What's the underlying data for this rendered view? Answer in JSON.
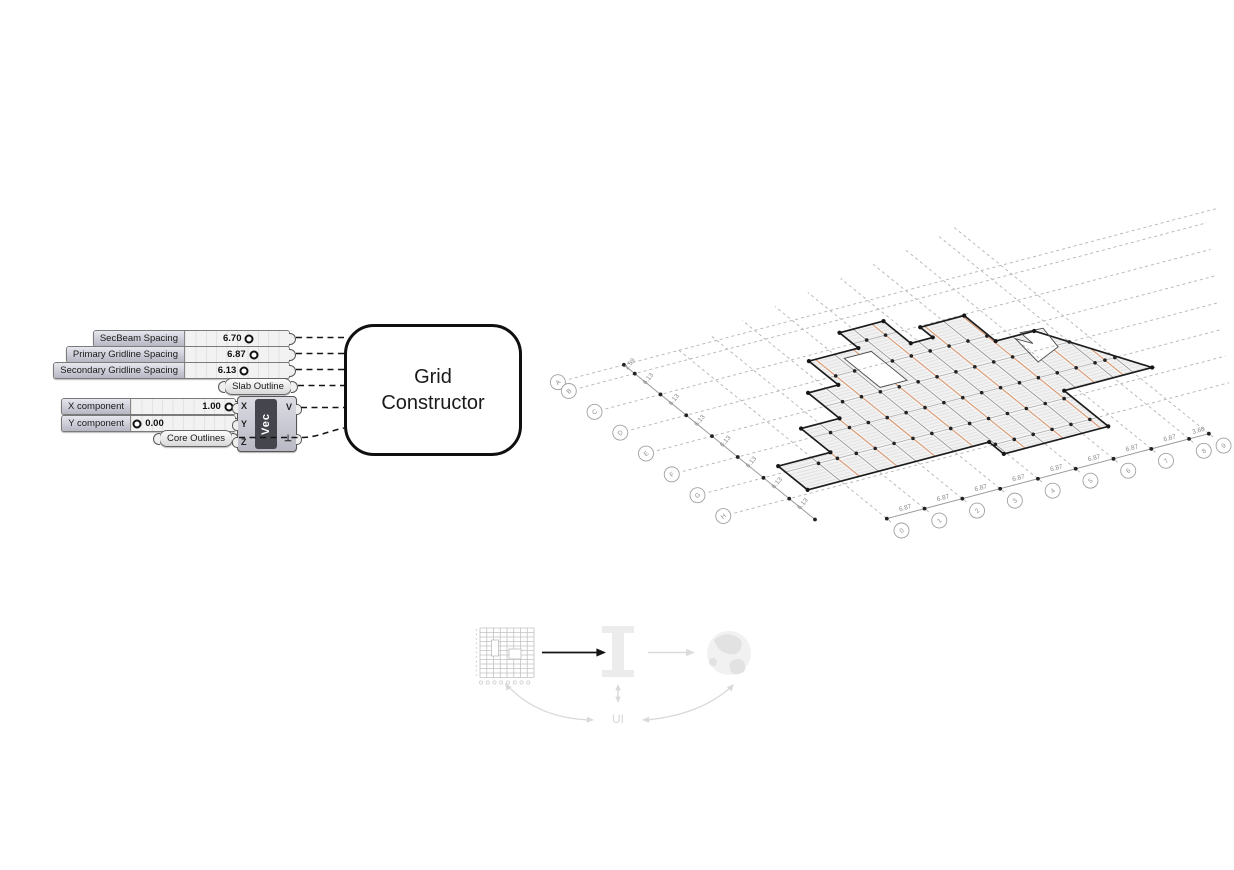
{
  "gh": {
    "sliders": [
      {
        "label": "SecBeam Spacing",
        "value": "6.70",
        "knob_pct": 62,
        "value_side": "left"
      },
      {
        "label": "Primary Gridline Spacing",
        "value": "6.87",
        "knob_pct": 66,
        "value_side": "left"
      },
      {
        "label": "Secondary Gridline Spacing",
        "value": "6.13",
        "knob_pct": 57,
        "value_side": "left"
      },
      {
        "label": "X component",
        "value": "1.00",
        "knob_pct": 94,
        "value_side": "left"
      },
      {
        "label": "Y component",
        "value": "0.00",
        "knob_pct": 6,
        "value_side": "right"
      }
    ],
    "params": {
      "slab": "Slab Outline",
      "core": "Core Outlines"
    },
    "vec": {
      "label": "Vec",
      "inputs": [
        "X",
        "Y",
        "Z"
      ],
      "outputs": [
        "V",
        "⊥"
      ]
    },
    "cluster": {
      "line1": "Grid",
      "line2": "Constructor"
    }
  },
  "axon": {
    "letters": [
      "A",
      "B",
      "C",
      "D",
      "E",
      "F",
      "G",
      "H"
    ],
    "numbers": [
      "0",
      "1",
      "2",
      "3",
      "4",
      "5",
      "6",
      "7",
      "8",
      "9"
    ],
    "secondary_dims": [
      2.59,
      6.13,
      6.13,
      6.13,
      6.13,
      6.13,
      6.13,
      6.13
    ],
    "primary_dims": [
      6.87,
      6.87,
      6.87,
      6.87,
      6.87,
      6.87,
      6.87,
      6.87,
      3.6
    ],
    "slab_outline": [
      [
        -6,
        7
      ],
      [
        27,
        7
      ],
      [
        27,
        3.5
      ],
      [
        46,
        3.5
      ],
      [
        46,
        14
      ],
      [
        62,
        14
      ],
      [
        52,
        29
      ],
      [
        45,
        29
      ],
      [
        45,
        36.5
      ],
      [
        37,
        36.5
      ],
      [
        37,
        33.5
      ],
      [
        33,
        33.5
      ],
      [
        33,
        40
      ],
      [
        25,
        40
      ],
      [
        25,
        35.5
      ],
      [
        16,
        35.5
      ],
      [
        16,
        28.5
      ],
      [
        10.5,
        28.5
      ],
      [
        10.5,
        21
      ],
      [
        3.5,
        21
      ],
      [
        3.5,
        14
      ],
      [
        -6,
        14
      ]
    ],
    "openings": [
      [
        [
          21.3,
          25.5
        ],
        [
          26.2,
          25.5
        ],
        [
          26.2,
          34
        ],
        [
          21.3,
          34
        ]
      ],
      [
        [
          47.3,
          21.9
        ],
        [
          52.6,
          24.1
        ],
        [
          53.7,
          29.1
        ],
        [
          49.8,
          29.4
        ],
        [
          49.7,
          26.3
        ],
        [
          48.1,
          28.4
        ]
      ]
    ],
    "colors": {
      "secondary_beam": "#d9a07e",
      "gridline": "#9c9c9c",
      "outline": "#1c1c1c",
      "bubble": "#a0a0a0"
    }
  },
  "workflow": {
    "ui_label": "UI"
  }
}
